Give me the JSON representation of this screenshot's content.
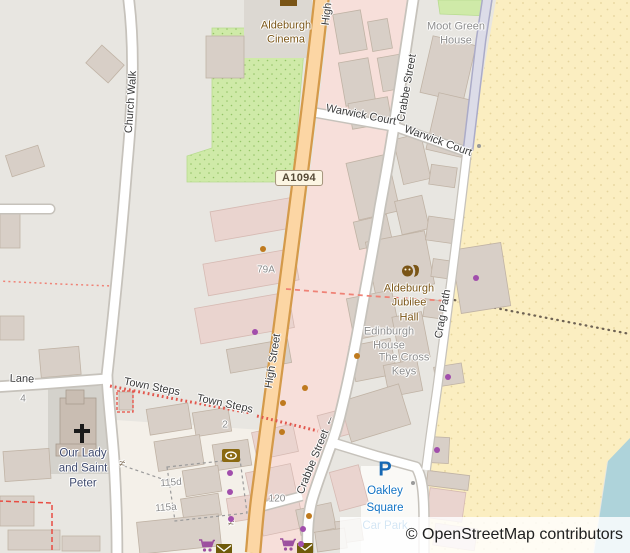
{
  "map": {
    "attribution": "© OpenStreetMap contributors",
    "shield": "A1094",
    "colors": {
      "primary_road": "#fcd6a4",
      "primary_casing": "#d49a4a",
      "road_fill": "#ffffff",
      "road_casing": "#c6c2bb",
      "retail_landuse": "#f7dfda",
      "residential_landuse": "#e8e6e1",
      "building": "#d8cfc7",
      "building_pink": "#ead4cf",
      "beach": "#fbeec1",
      "sea": "#aed3da",
      "green": "#cfeaa8",
      "pedestrian_path": "#dcdce8",
      "footpath_red": "#e84c42",
      "shop_dot": "#a14eac",
      "amenity_dot": "#bf7a1e",
      "poi_brown": "#7a5516",
      "parking_blue": "#1668b4",
      "label_grey": "#8d8d8d",
      "label_navy": "#3f4a6e",
      "label_blue": "#1273c4"
    },
    "labels": [
      {
        "id": "high-street-top",
        "style": "street",
        "text": "High",
        "x": 327,
        "y": 14,
        "rot": -83
      },
      {
        "id": "church-walk",
        "style": "street",
        "text": "Church Walk",
        "x": 131,
        "y": 102,
        "rot": -86
      },
      {
        "id": "crabbe-street-top",
        "style": "street",
        "text": "Crabbe Street",
        "x": 407,
        "y": 88,
        "rot": -80
      },
      {
        "id": "warwick-court-west",
        "style": "street",
        "text": "Warwick Court",
        "x": 361,
        "y": 115,
        "rot": 11
      },
      {
        "id": "warwick-court-east",
        "style": "street",
        "text": "Warwick Court",
        "x": 438,
        "y": 141,
        "rot": 20
      },
      {
        "id": "moot-green-house",
        "style": "place_grey",
        "lines": [
          "Moot Green",
          "House"
        ],
        "x": 456,
        "y": 34,
        "rot": 0
      },
      {
        "id": "aldeburgh-cinema",
        "style": "place_brown",
        "lines": [
          "Aldeburgh",
          "Cinema"
        ],
        "x": 286,
        "y": 33,
        "rot": 0
      },
      {
        "id": "house-79a",
        "style": "housenum",
        "text": "79A",
        "x": 266,
        "y": 270,
        "rot": 0
      },
      {
        "id": "high-street-mid",
        "style": "street",
        "text": "High Street",
        "x": 273,
        "y": 361,
        "rot": -81
      },
      {
        "id": "crag-path",
        "style": "street",
        "text": "Crag Path",
        "x": 443,
        "y": 314,
        "rot": -80
      },
      {
        "id": "aldeburgh-jubilee-hall",
        "style": "place_brown",
        "lines": [
          "Aldeburgh",
          "Jubilee",
          "Hall"
        ],
        "x": 409,
        "y": 303,
        "rot": 0
      },
      {
        "id": "edinburgh-house",
        "style": "place_grey",
        "lines": [
          "Edinburgh",
          "House"
        ],
        "x": 389,
        "y": 339,
        "rot": 0
      },
      {
        "id": "the-cross-keys",
        "style": "place_grey",
        "lines": [
          "The Cross",
          "Keys"
        ],
        "x": 404,
        "y": 365,
        "rot": 0
      },
      {
        "id": "lane",
        "style": "street",
        "text": "Lane",
        "x": 22,
        "y": 379,
        "rot": 2
      },
      {
        "id": "town-steps-west",
        "style": "street",
        "text": "Town Steps",
        "x": 152,
        "y": 387,
        "rot": 11
      },
      {
        "id": "town-steps-east",
        "style": "street",
        "text": "Town Steps",
        "x": 225,
        "y": 404,
        "rot": 12
      },
      {
        "id": "house-4",
        "style": "housenum",
        "text": "4",
        "x": 23,
        "y": 399,
        "rot": 0
      },
      {
        "id": "our-lady-and-saint-peter",
        "style": "place_navy",
        "lines": [
          "Our Lady",
          "and Saint",
          "Peter"
        ],
        "x": 83,
        "y": 469,
        "rot": 0
      },
      {
        "id": "house-115d",
        "style": "housenum",
        "text": "115d",
        "x": 171,
        "y": 483,
        "rot": -4
      },
      {
        "id": "house-115a",
        "style": "housenum",
        "text": "115a",
        "x": 166,
        "y": 508,
        "rot": -4
      },
      {
        "id": "house-2",
        "style": "housenum",
        "text": "2",
        "x": 225,
        "y": 425,
        "rot": 0
      },
      {
        "id": "house-120",
        "style": "housenum",
        "text": "120",
        "x": 277,
        "y": 499,
        "rot": 0
      },
      {
        "id": "crabbe-street-bottom",
        "style": "street",
        "text": "Crabbe Street",
        "x": 313,
        "y": 462,
        "rot": -68
      },
      {
        "id": "oneway-arrow",
        "style": "arrow",
        "text": "←",
        "x": 328,
        "y": 420,
        "rot": -68
      },
      {
        "id": "oakley-square-car-park",
        "style": "place_blue",
        "lines": [
          "Oakley",
          "Square",
          "Car Park"
        ],
        "x": 385,
        "y": 509,
        "rot": 0
      },
      {
        "id": "parking-symbol",
        "style": "parking",
        "text": "P",
        "x": 385,
        "y": 470,
        "rot": 0
      },
      {
        "id": "gate-west",
        "style": "gate",
        "text": "≠",
        "x": 122,
        "y": 464,
        "rot": 12
      },
      {
        "id": "gate-mid",
        "style": "gate",
        "text": "≠",
        "x": 231,
        "y": 523,
        "rot": 12
      }
    ],
    "icons": [
      {
        "name": "cinema-icon",
        "x": 289,
        "y": 2
      },
      {
        "name": "theatre-masks-icon",
        "x": 410,
        "y": 272
      },
      {
        "name": "christian-cross-icon",
        "x": 82,
        "y": 433
      },
      {
        "name": "bank-icon",
        "x": 231,
        "y": 456
      },
      {
        "name": "supermarket-icon",
        "x": 206,
        "y": 545
      },
      {
        "name": "post-office-icon",
        "x": 224,
        "y": 550
      },
      {
        "name": "supermarket-icon-2",
        "x": 287,
        "y": 544
      },
      {
        "name": "post-office-icon-2",
        "x": 305,
        "y": 549
      }
    ],
    "poi_dots": {
      "shop": [
        [
          255,
          332
        ],
        [
          230,
          473
        ],
        [
          230,
          492
        ],
        [
          231,
          519
        ],
        [
          303,
          529
        ],
        [
          301,
          544
        ],
        [
          476,
          278
        ],
        [
          448,
          377
        ],
        [
          437,
          450
        ]
      ],
      "amenity": [
        [
          263,
          249
        ],
        [
          357,
          356
        ],
        [
          305,
          388
        ],
        [
          283,
          403
        ],
        [
          282,
          432
        ],
        [
          309,
          516
        ]
      ],
      "minor": [
        [
          479,
          146
        ],
        [
          413,
          483
        ]
      ]
    }
  }
}
